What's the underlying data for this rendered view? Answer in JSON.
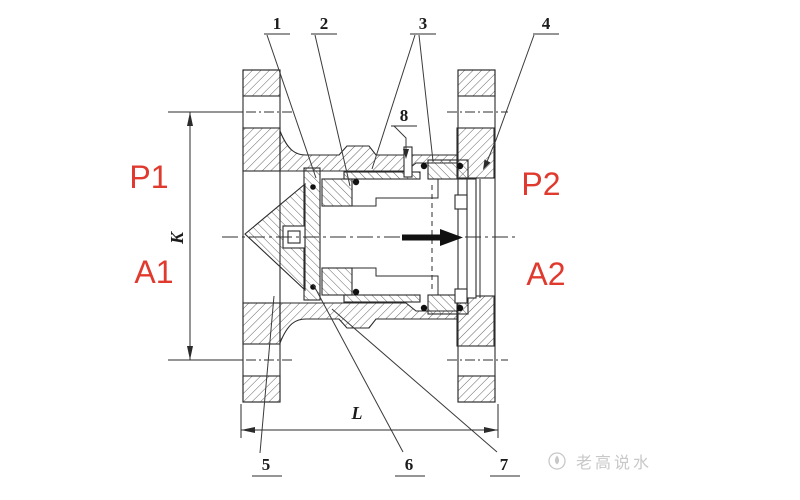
{
  "figure": {
    "type": "valve-sectional-drawing",
    "colors": {
      "line": "#2b2b2b",
      "port_red": "#e03a2f",
      "watermark_gray": "#c8c8c8"
    },
    "flow_arrow_icon": "right-arrow",
    "ports": {
      "p1": "P1",
      "a1": "A1",
      "p2": "P2",
      "a2": "A2"
    },
    "dimensions": {
      "vertical": "K",
      "horizontal": "L"
    },
    "callouts": [
      {
        "label": "1"
      },
      {
        "label": "2"
      },
      {
        "label": "3"
      },
      {
        "label": "4"
      },
      {
        "label": "5"
      },
      {
        "label": "6"
      },
      {
        "label": "7"
      },
      {
        "label": "8"
      }
    ],
    "watermark": {
      "text": "老高说水"
    }
  }
}
